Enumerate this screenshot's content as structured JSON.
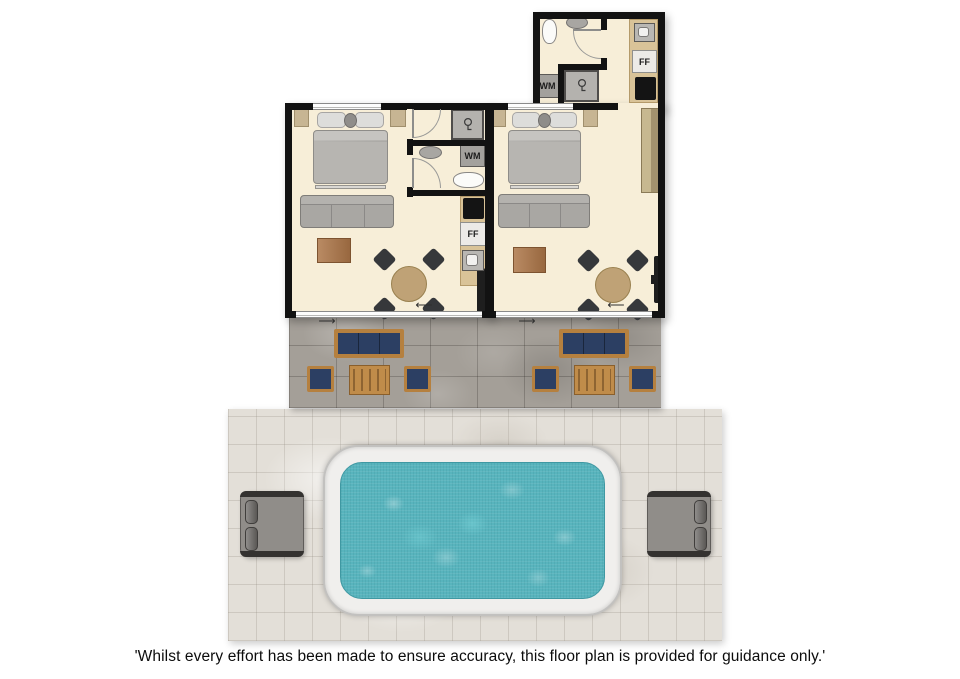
{
  "disclaimer": "'Whilst every effort has been made to ensure accuracy, this floor plan is provided for guidance only.'",
  "labels": {
    "washing_machine": "WM",
    "fridge_freezer": "FF"
  },
  "symbols": {
    "entry_arrow_left": "⟵",
    "entry_arrow_right": "⟶"
  },
  "colors": {
    "wall": "#121212",
    "floor": "#f7eed8",
    "kitchen_counter": "#d9c398",
    "patio_tile": "#a49f98",
    "deck_tile": "#e3dfd8",
    "pool_surround": "#f0efed",
    "pool_water": "#58b4bd",
    "outdoor_cushion_navy": "#2c3f63",
    "outdoor_wood": "#b5803f",
    "indoor_sofa_gray": "#a9a7a3",
    "coffee_table_wood": "#ad7648",
    "lounger_gray": "#908d89"
  },
  "units": [
    {
      "id": "left-apartment",
      "items": [
        "double bed",
        "two bedside tables",
        "three-seat sofa",
        "wooden coffee table",
        "round dining table with four chairs",
        "kitchenette with hob, fridge freezer and sink",
        "shower room",
        "WC with basin, washing machine and toilet",
        "wall TV",
        "sliding patio doors"
      ]
    },
    {
      "id": "right-apartment",
      "items": [
        "double bed",
        "two bedside tables",
        "three-seat sofa",
        "wooden coffee table",
        "round dining table with four chairs",
        "wardrobe",
        "kitchenette with sink, fridge freezer and hob",
        "bathroom with toilet, basin, shower and washing machine",
        "wall TV",
        "sliding patio doors"
      ]
    }
  ],
  "outdoor": {
    "patio": [
      "two navy outdoor sofas",
      "four navy outdoor armchairs",
      "two wooden outdoor tables"
    ],
    "pool_area": [
      "swimming pool",
      "two sun loungers"
    ]
  }
}
